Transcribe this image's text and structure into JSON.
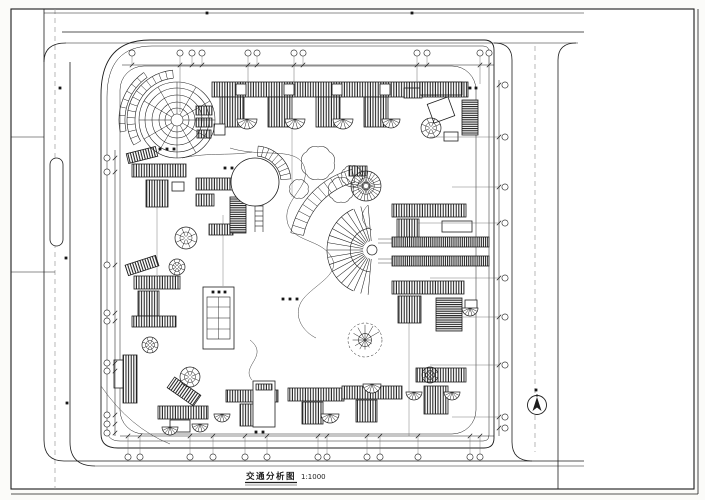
{
  "title_block": {
    "title": "交通分析图",
    "scale": "1:1000"
  },
  "colors": {
    "ink": "#1d1d1d",
    "soft": "#5f5f5f",
    "centerline": "#9a9a9a",
    "paper": "#ffffff"
  },
  "plan": {
    "blocks": [
      [
        212,
        82,
        256,
        15,
        "h"
      ],
      [
        236,
        84,
        10,
        11,
        "p"
      ],
      [
        284,
        84,
        10,
        11,
        "p"
      ],
      [
        332,
        84,
        10,
        11,
        "p"
      ],
      [
        380,
        84,
        10,
        11,
        "p"
      ],
      [
        428,
        84,
        10,
        11,
        "p"
      ],
      [
        220,
        97,
        24,
        30,
        "h"
      ],
      [
        268,
        97,
        24,
        30,
        "h"
      ],
      [
        316,
        97,
        24,
        30,
        "h"
      ],
      [
        364,
        97,
        24,
        30,
        "h"
      ],
      [
        404,
        88,
        18,
        10,
        "h"
      ],
      [
        420,
        82,
        42,
        13,
        "h"
      ],
      [
        430,
        100,
        22,
        20,
        "p",
        -20
      ],
      [
        462,
        100,
        16,
        35,
        "d"
      ],
      [
        444,
        132,
        14,
        9,
        "p"
      ],
      [
        196,
        106,
        16,
        9,
        "h"
      ],
      [
        196,
        118,
        16,
        9,
        "h"
      ],
      [
        197,
        130,
        14,
        8,
        "h"
      ],
      [
        214,
        124,
        11,
        11,
        "p"
      ],
      [
        127,
        150,
        30,
        10,
        "h",
        -14
      ],
      [
        132,
        164,
        54,
        13,
        "h"
      ],
      [
        146,
        180,
        22,
        27,
        "h"
      ],
      [
        172,
        182,
        12,
        9,
        "p"
      ],
      [
        196,
        178,
        46,
        12,
        "h"
      ],
      [
        196,
        194,
        18,
        12,
        "h"
      ],
      [
        209,
        224,
        24,
        11,
        "h"
      ],
      [
        230,
        197,
        16,
        36,
        "d"
      ],
      [
        349,
        166,
        18,
        10,
        "h"
      ],
      [
        392,
        204,
        74,
        13,
        "h"
      ],
      [
        397,
        219,
        22,
        26,
        "h"
      ],
      [
        442,
        221,
        30,
        11,
        "p"
      ],
      [
        392,
        281,
        72,
        13,
        "h"
      ],
      [
        398,
        296,
        23,
        27,
        "h"
      ],
      [
        436,
        298,
        26,
        33,
        "d"
      ],
      [
        465,
        300,
        12,
        9,
        "p"
      ],
      [
        126,
        260,
        32,
        11,
        "h",
        -18
      ],
      [
        134,
        276,
        46,
        13,
        "h"
      ],
      [
        138,
        291,
        21,
        25,
        "h"
      ],
      [
        132,
        316,
        44,
        11,
        "h"
      ],
      [
        114,
        360,
        10,
        28,
        "p"
      ],
      [
        123,
        355,
        14,
        48,
        "h"
      ],
      [
        168,
        385,
        32,
        13,
        "h",
        35
      ],
      [
        158,
        406,
        50,
        13,
        "h"
      ],
      [
        170,
        420,
        20,
        12,
        "p"
      ],
      [
        226,
        390,
        52,
        12,
        "h"
      ],
      [
        240,
        404,
        21,
        22,
        "h"
      ],
      [
        253,
        381,
        22,
        46,
        "p"
      ],
      [
        256,
        384,
        16,
        6,
        "h"
      ],
      [
        288,
        388,
        56,
        13,
        "h"
      ],
      [
        302,
        402,
        21,
        22,
        "h"
      ],
      [
        342,
        386,
        60,
        13,
        "h"
      ],
      [
        356,
        400,
        21,
        22,
        "h"
      ],
      [
        416,
        368,
        50,
        14,
        "h"
      ],
      [
        424,
        386,
        24,
        28,
        "h"
      ]
    ],
    "pergolas": [
      [
        392,
        237,
        97,
        10
      ],
      [
        392,
        256,
        97,
        10
      ]
    ],
    "rosettes": [
      [
        186,
        238,
        11
      ],
      [
        177,
        267,
        8
      ],
      [
        150,
        345,
        8
      ],
      [
        190,
        377,
        10
      ],
      [
        431,
        128,
        10
      ],
      [
        430,
        375,
        8
      ]
    ],
    "dense_rosette": [
      366,
      186,
      15
    ],
    "fans": [
      [
        247,
        119,
        10
      ],
      [
        295,
        119,
        10
      ],
      [
        343,
        119,
        10
      ],
      [
        391,
        119,
        9
      ],
      [
        170,
        427,
        8
      ],
      [
        200,
        424,
        8
      ],
      [
        222,
        414,
        8
      ],
      [
        330,
        414,
        9
      ],
      [
        372,
        384,
        9
      ],
      [
        414,
        392,
        8
      ],
      [
        452,
        392,
        8
      ],
      [
        470,
        308,
        8
      ]
    ],
    "spirals": [
      [
        365,
        340,
        17
      ]
    ],
    "clouds": [
      [
        318,
        163,
        16
      ],
      [
        341,
        190,
        12
      ],
      [
        299,
        189,
        9
      ],
      [
        352,
        176,
        10
      ]
    ],
    "plaza": {
      "cx": 177,
      "cy": 120,
      "rings": [
        6,
        12,
        18,
        25,
        32,
        38
      ],
      "spokes": 12,
      "bands": [
        [
          42,
          50,
          150,
          265,
          14
        ],
        [
          52,
          58,
          168,
          235,
          8
        ]
      ]
    },
    "circle_plaza": {
      "cx": 255,
      "cy": 182,
      "r": 24,
      "band": [
        26,
        36,
        -85,
        -5,
        9
      ]
    },
    "fan_feature": {
      "cx": 372,
      "cy": 250,
      "hub": 5,
      "r1": 9,
      "r2": 45,
      "a1": 95,
      "a2": 265,
      "n": 19,
      "arcs": [
        [
          22,
          95,
          265
        ],
        [
          45,
          115,
          245
        ]
      ]
    },
    "step_bands": [
      [
        372,
        250,
        70,
        83,
        192,
        256,
        12
      ]
    ],
    "grid": {
      "top": {
        "chain_y": 65,
        "x1": 122,
        "x2": 494,
        "bubble_y": 53,
        "xs": [
          132,
          180,
          192,
          202,
          248,
          257,
          294,
          303,
          417,
          427,
          480,
          489
        ],
        "drops": [
          [
            180,
            112
          ],
          [
            248,
            82
          ],
          [
            294,
            82
          ],
          [
            417,
            84
          ],
          [
            480,
            84
          ]
        ]
      },
      "bottom": {
        "chain_y": 436,
        "x1": 120,
        "x2": 494,
        "bubble_y": 457,
        "xs": [
          128,
          140,
          190,
          213,
          245,
          267,
          318,
          327,
          367,
          380,
          418,
          470,
          480
        ]
      },
      "left": {
        "chain_x": 115,
        "y1": 150,
        "y2": 436,
        "bubble_x": 107,
        "ys": [
          158,
          172,
          265,
          313,
          321,
          363,
          371,
          415,
          424,
          433
        ]
      },
      "right": {
        "chain_x": 499,
        "y1": 80,
        "y2": 436,
        "bubble_x": 505,
        "ys": [
          85,
          137,
          187,
          223,
          278,
          317,
          365,
          417,
          428
        ],
        "leaders": [
          [
            137,
            430
          ],
          [
            187,
            452
          ],
          [
            223,
            418
          ],
          [
            278,
            430
          ],
          [
            317,
            440
          ],
          [
            365,
            430
          ],
          [
            417,
            452
          ]
        ]
      }
    },
    "dots": [
      [
        213,
        292
      ],
      [
        219,
        292
      ],
      [
        225,
        292
      ],
      [
        283,
        299
      ],
      [
        290,
        299
      ],
      [
        297,
        299
      ],
      [
        256,
        432
      ],
      [
        263,
        432
      ],
      [
        160,
        149
      ],
      [
        167,
        149
      ],
      [
        174,
        149
      ],
      [
        225,
        168
      ],
      [
        232,
        168
      ],
      [
        470,
        88
      ],
      [
        476,
        88
      ],
      [
        207,
        13
      ],
      [
        412,
        13
      ],
      [
        60,
        88
      ],
      [
        66,
        258
      ],
      [
        67,
        403
      ],
      [
        536,
        390
      ]
    ],
    "north_arrow": {
      "cx": 537,
      "cy": 405,
      "r": 9.5
    }
  }
}
